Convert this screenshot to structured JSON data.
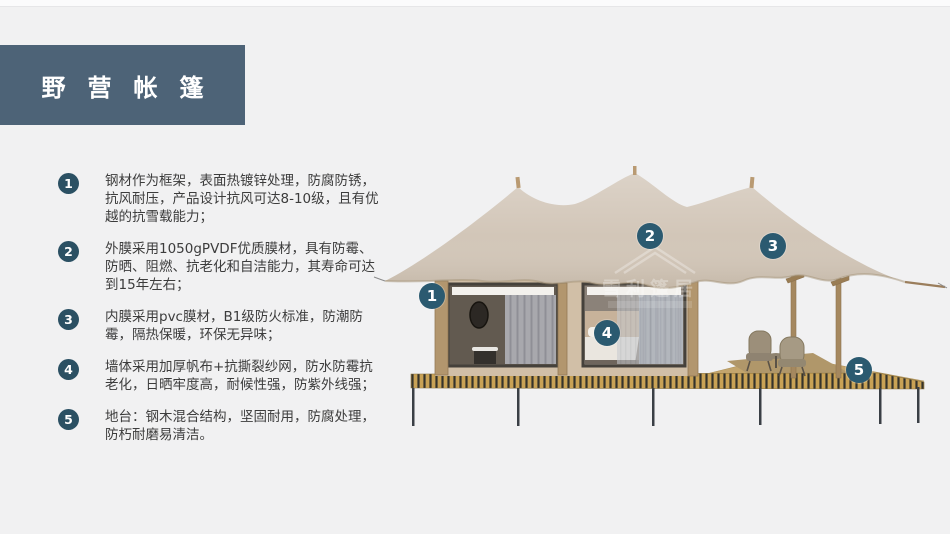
{
  "title": {
    "text": "野营帐篷"
  },
  "features": [
    {
      "number": "1",
      "text": "钢材作为框架，表面热镀锌处理，防腐防锈，抗风耐压，产品设计抗风可达8-10级，且有优越的抗雪载能力；"
    },
    {
      "number": "2",
      "text": "外膜采用1050gPVDF优质膜材，具有防霉、防晒、阻燃、抗老化和自洁能力，其寿命可达到15年左右；"
    },
    {
      "number": "3",
      "text": "内膜采用pvc膜材，B1级防火标准，防潮防霉，隔热保暖，环保无异味；"
    },
    {
      "number": "4",
      "text": "墙体采用加厚帆布+抗撕裂纱网，防水防霉抗老化，日晒牢度高，耐候性强，防紫外线强；"
    },
    {
      "number": "5",
      "text": "地台：钢木混合结构，坚固耐用，防腐处理，防朽耐磨易清洁。"
    }
  ],
  "callouts": [
    {
      "number": "1"
    },
    {
      "number": "2"
    },
    {
      "number": "3"
    },
    {
      "number": "4"
    },
    {
      "number": "5"
    }
  ],
  "illustration": {
    "watermark": "雪利篷居"
  },
  "colors": {
    "background": "#f1f1f2",
    "title_bg": "#4d6377",
    "list_badge": "#2b5063",
    "callout_badge": "#2b5a70",
    "canopy": "#d2c6b8",
    "wall": "#d1bfa7",
    "deck_gold": "#c9a255"
  }
}
